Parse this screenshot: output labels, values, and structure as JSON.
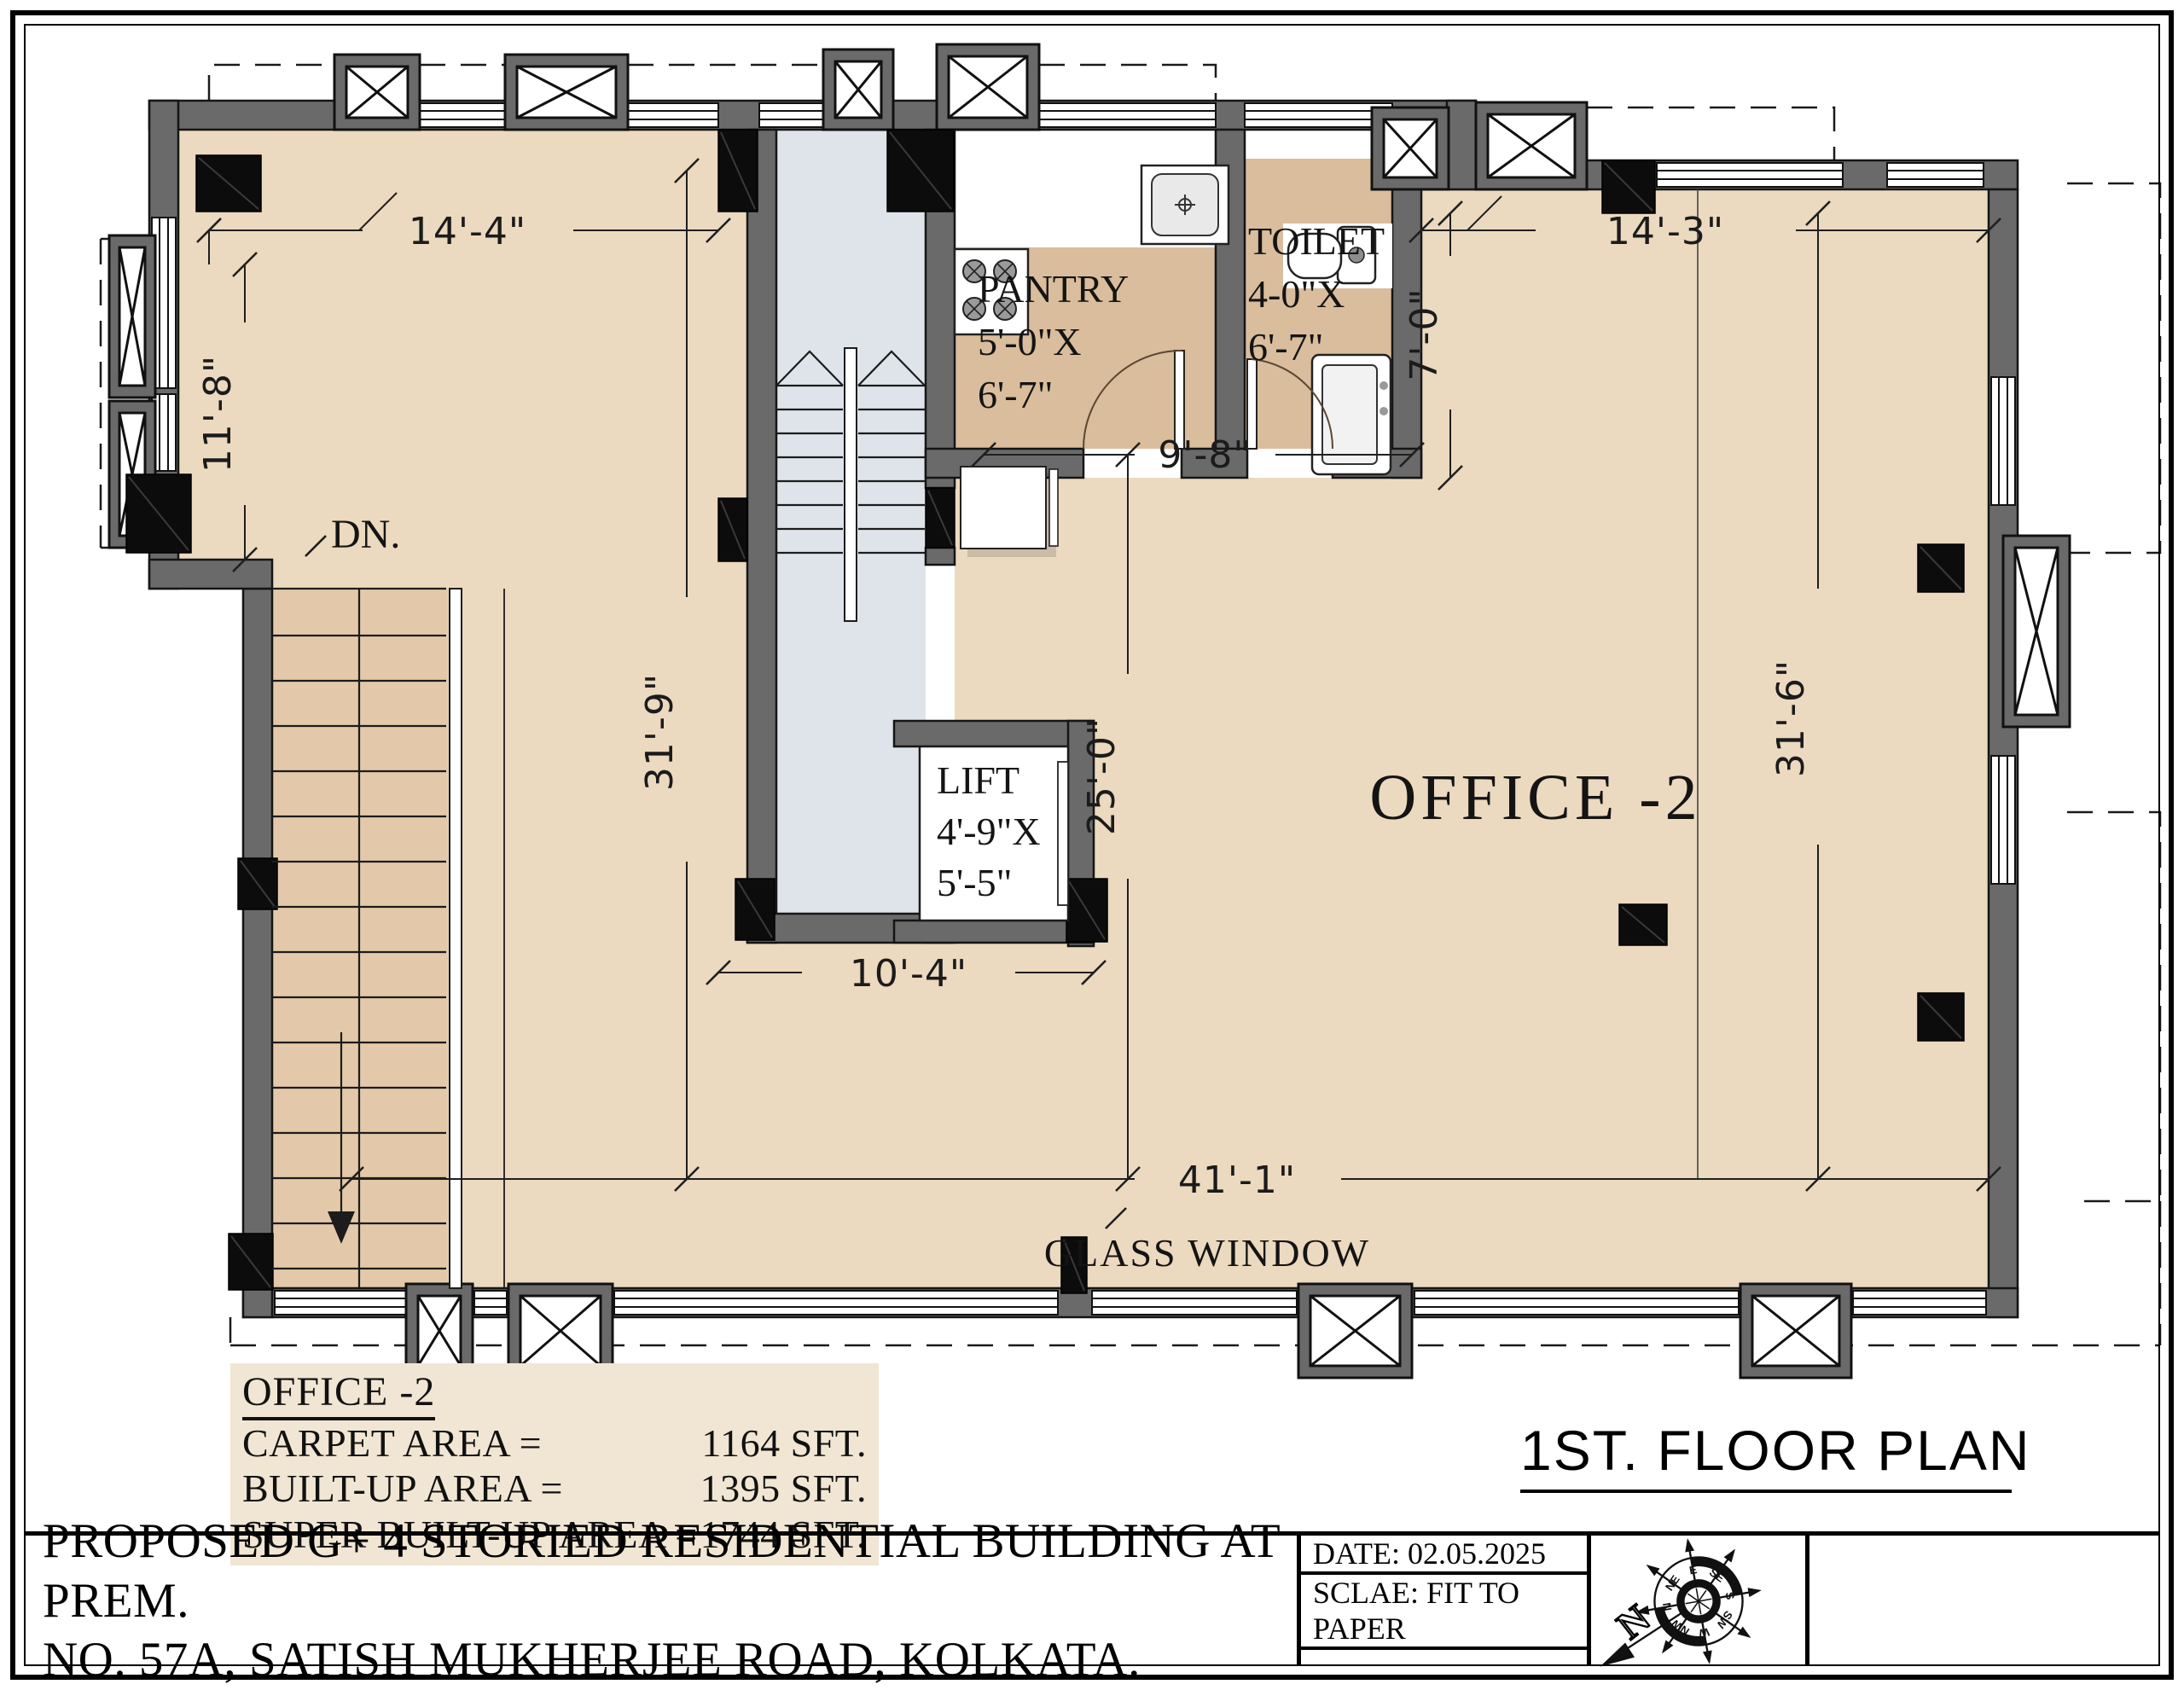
{
  "page": {
    "floor_plan_title": "1ST. FLOOR PLAN"
  },
  "plan": {
    "labels": {
      "dn": "DN.",
      "office": "OFFICE -2",
      "glass_window": "GLASS WINDOW"
    },
    "lift": {
      "line1": "LIFT",
      "line2": "4'-9\"X",
      "line3": "5'-5\""
    },
    "pantry": {
      "line1": "PANTRY",
      "line2": "5'-0\"X",
      "line3": "6'-7\""
    },
    "toilet": {
      "line1": "TOILET",
      "line2": "4-0\"X",
      "line3": "6'-7\""
    },
    "dimensions": {
      "top_left_width": "14'-4\"",
      "top_left_height": "11'-8\"",
      "left_height": "31'-9\"",
      "pantry_toilet_width": "9'-8\"",
      "toilet_height": "7'-0\"",
      "top_right_width": "14'-3\"",
      "lobby_height": "25'-0\"",
      "right_height": "31'-6\"",
      "core_width": "10'-4\"",
      "bottom_width": "41'-1\""
    }
  },
  "area_table": {
    "heading": "OFFICE -2",
    "rows": [
      {
        "label": "CARPET AREA =",
        "value": "1164 SFT."
      },
      {
        "label": "BUILT-UP AREA =",
        "value": "1395 SFT."
      },
      {
        "label": "SUPER BUILT-UP AREA =",
        "value": "1744 SFT."
      }
    ]
  },
  "title_block": {
    "project_line1": "PROPOSED G+ 4 STORIED RESIDENTIAL BUILDING AT PREM.",
    "project_line2": "NO. 57A, SATISH MUKHERJEE ROAD, KOLKATA.",
    "date": "DATE: 02.05.2025",
    "scale": "SCLAE: FIT TO PAPER"
  },
  "compass": {
    "north": "N",
    "directions": [
      "N",
      "NE",
      "E",
      "SE",
      "S",
      "SW",
      "W",
      "NW"
    ]
  },
  "colors": {
    "floor": "#ebd9c0",
    "service_floor": "#d9bd9c",
    "core_floor": "#dfe4ea",
    "wall": "#6a6a6a",
    "column": "#0c0c0c"
  }
}
